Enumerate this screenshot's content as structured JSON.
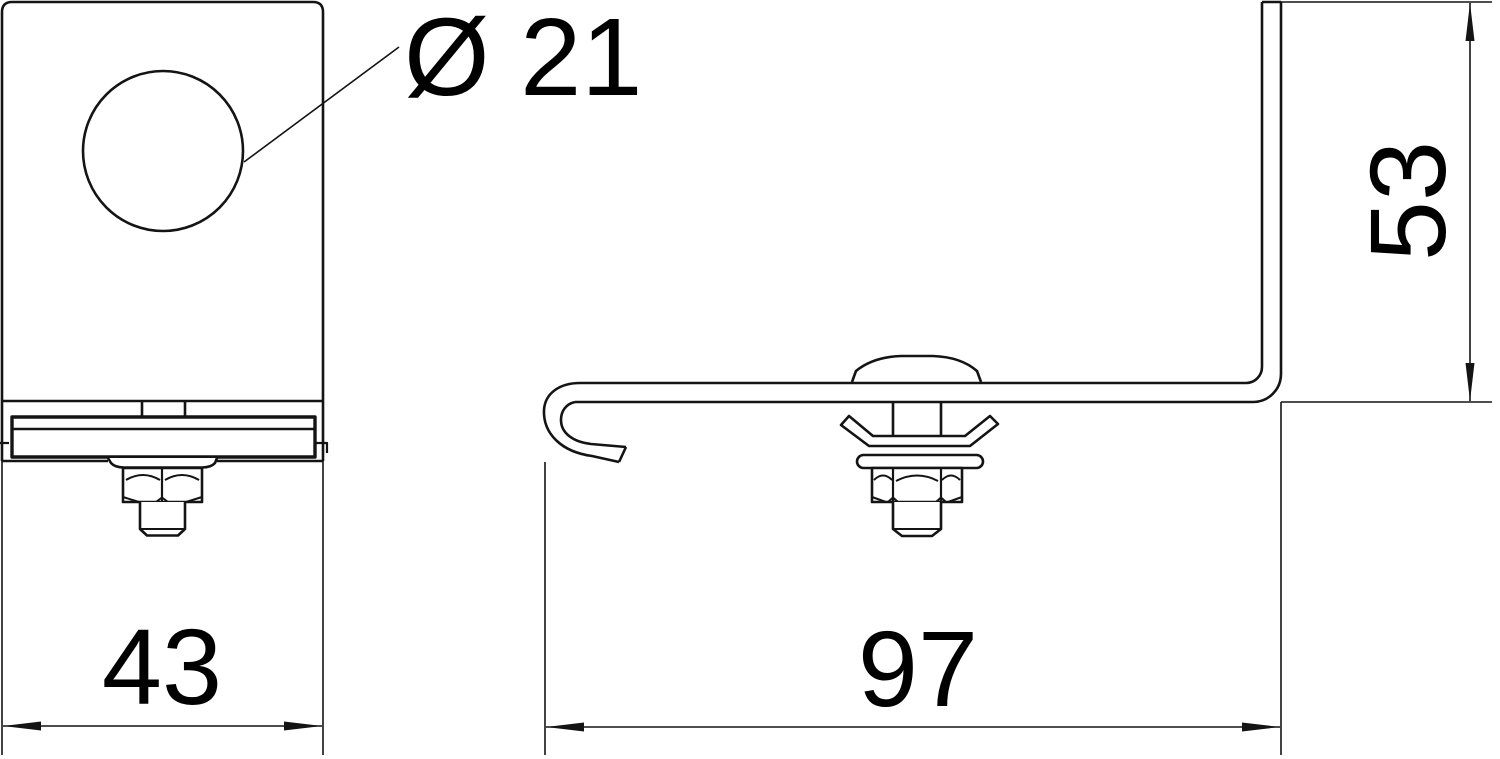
{
  "page": {
    "background": "#ffffff",
    "line_color": "#141414",
    "kind": "technical line drawing — two orthographic views of a hook clamp bracket with bolt, claw washer, hex nut and threaded stud"
  },
  "drawing": {
    "front_view": {
      "name": "front view",
      "features": [
        "mounting-plate",
        "round-hole",
        "fold-line",
        "clamping-bar",
        "flange-washer",
        "hex-nut",
        "threaded-stud"
      ],
      "hole_callout": {
        "label": "Ø 21",
        "value": 21,
        "kind": "diameter"
      },
      "width_dim": {
        "label": "43",
        "value": 43,
        "kind": "linear-horizontal"
      }
    },
    "side_view": {
      "name": "side view",
      "features": [
        "hooked-strip",
        "vertical-leg",
        "dome-head-bolt",
        "square-neck",
        "claw-washer",
        "flange-washer",
        "hex-nut",
        "threaded-stud"
      ],
      "length_dim": {
        "label": "97",
        "value": 97,
        "kind": "linear-horizontal"
      },
      "height_dim": {
        "label": "53",
        "value": 53,
        "kind": "linear-vertical"
      }
    }
  }
}
